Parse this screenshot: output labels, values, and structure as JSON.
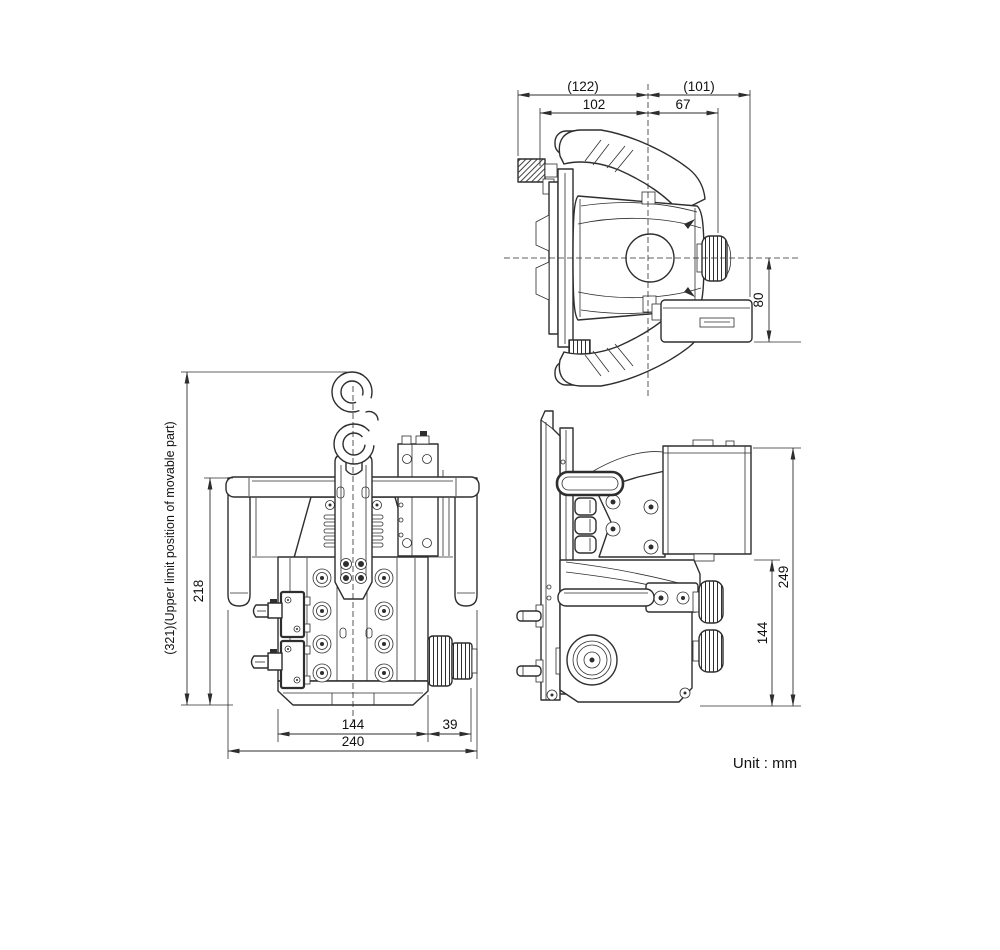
{
  "drawing": {
    "unit_label": "Unit : mm",
    "line_color": "#2e2e2e",
    "views": {
      "top_view": {
        "dimensions": {
          "overall_width_left": "(122)",
          "inner_width_left": "102",
          "inner_width_right": "67",
          "overall_width_right": "(101)",
          "junction_box_height": "80"
        }
      },
      "front_view": {
        "dimensions": {
          "upper_limit_height": "(321)(Upper limit position of movable part)",
          "frame_height": "218",
          "body_width": "144",
          "connector_width": "39",
          "overall_width": "240"
        }
      },
      "side_view": {
        "dimensions": {
          "overall_height": "249",
          "lower_height": "144"
        }
      }
    }
  }
}
